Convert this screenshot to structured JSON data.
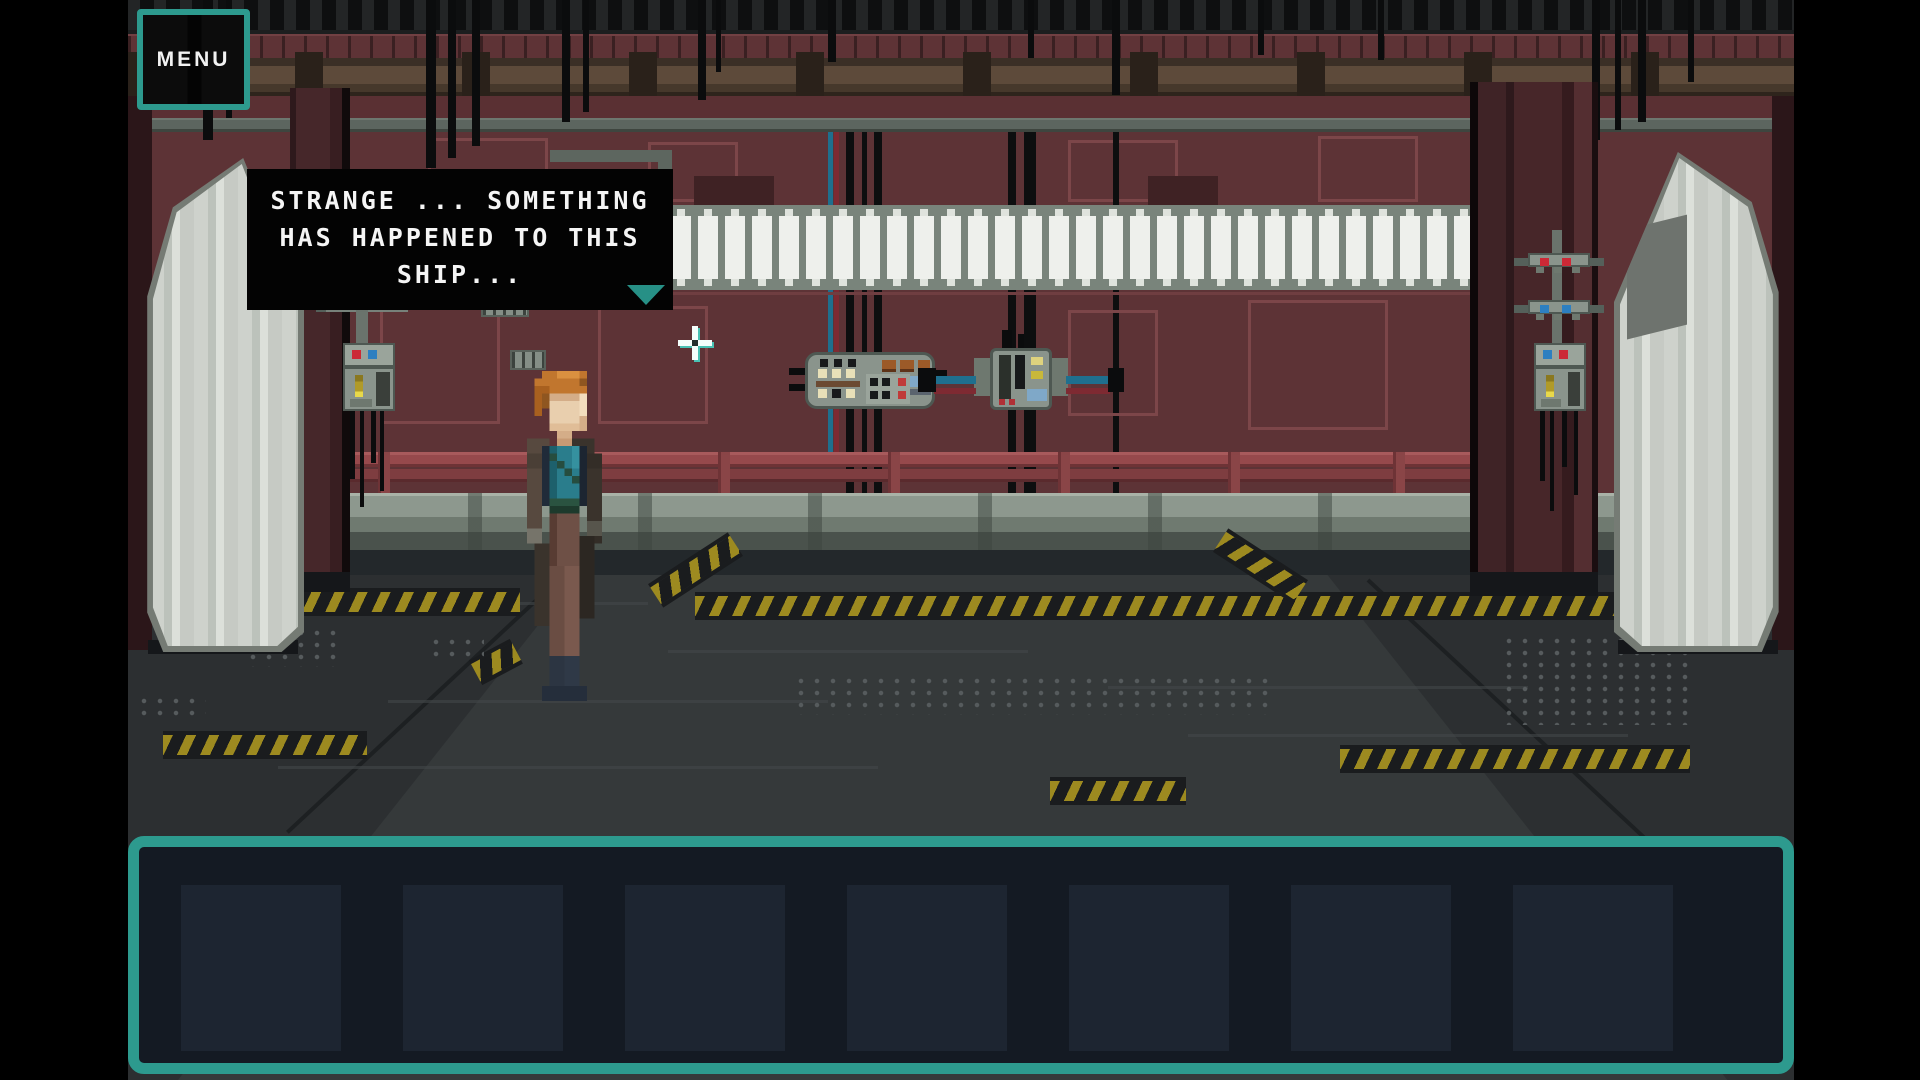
{
  "ui": {
    "menu_button": {
      "label": "MENU"
    },
    "dialogue_box": {
      "full_text": "STRANGE ... SOMETHING HAS HAPPENED TO THIS SHIP...",
      "lines": [
        "STRANGE ... SOMETHING",
        "HAS HAPPENED TO THIS",
        "SHIP..."
      ],
      "continue_icon": "triangle-down"
    },
    "inventory_bar": {
      "slot_count": 7,
      "slots": [
        "",
        "",
        "",
        "",
        "",
        "",
        ""
      ]
    },
    "cursor": {
      "icon": "crosshair",
      "x": 695,
      "y": 343
    }
  },
  "scene": {
    "description": "pixel-art spaceship corridor with maroon walls, white light strip, hazard-striped floor and a red-haired character in a coat",
    "hotspots": [
      "left-door",
      "right-door",
      "left-wall-device",
      "right-wall-device",
      "control-panel-left",
      "control-panel-right"
    ]
  },
  "colors": {
    "accent_teal": "#2d9a8e",
    "dialog_bg": "#030303",
    "inventory_bg": "#141a23",
    "slot_bg": "#1d2531",
    "wall_maroon": "#5d3336",
    "hazard_yellow": "#9d8a20",
    "light_strip_white": "#eef0ec",
    "floor_grey": "#2c2f31"
  }
}
